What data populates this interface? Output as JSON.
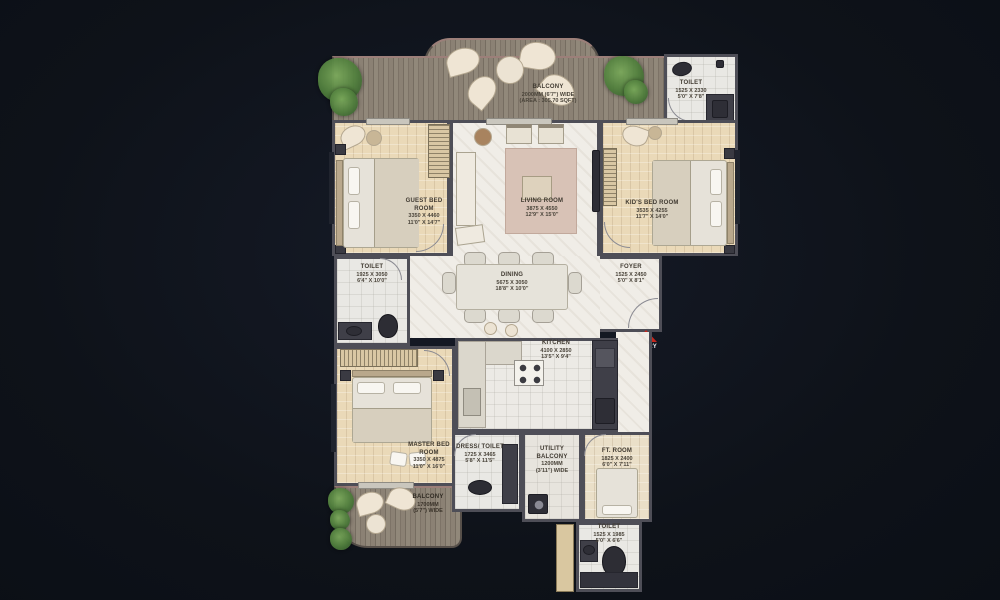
{
  "background_color": "#0e1219",
  "entry": {
    "label": "ENTRY",
    "arrow_color": "#c4271e"
  },
  "rooms": {
    "balcony_top": {
      "name": "BALCONY",
      "line2": "2000MM (6'7\") WIDE",
      "line3": "(AREA : 305.70 SQFT)"
    },
    "toilet_top": {
      "name": "TOILET",
      "dims_mm": "1525 X 2330",
      "dims_ft": "5'0\" X 7'8\""
    },
    "guest_bedroom": {
      "name": "GUEST BED ROOM",
      "dims_mm": "3350 X 4460",
      "dims_ft": "11'0\" X 14'7\""
    },
    "living_room": {
      "name": "LIVING ROOM",
      "dims_mm": "3875 X 4550",
      "dims_ft": "12'9\" X 15'0\""
    },
    "kids_bedroom": {
      "name": "KID'S BED ROOM",
      "dims_mm": "3535 X 4255",
      "dims_ft": "11'7\" X 14'0\""
    },
    "toilet_left": {
      "name": "TOILET",
      "dims_mm": "1925 X 3050",
      "dims_ft": "6'4\" X 10'0\""
    },
    "dining": {
      "name": "DINING",
      "dims_mm": "5675 X 3050",
      "dims_ft": "18'8\" X 10'0\""
    },
    "foyer": {
      "name": "FOYER",
      "dims_mm": "1525 X 2450",
      "dims_ft": "5'0\" X 8'1\""
    },
    "kitchen": {
      "name": "KITCHEN",
      "dims_mm": "4100 X 2850",
      "dims_ft": "13'5\" X 9'4\""
    },
    "master_bedroom": {
      "name": "MASTER BED ROOM",
      "dims_mm": "3350 X 4875",
      "dims_ft": "11'0\" X 16'0\""
    },
    "dress_toilet": {
      "name": "DRESS/ TOILET",
      "dims_mm": "1725 X 3465",
      "dims_ft": "5'8\" X 11'5\""
    },
    "utility_balcony": {
      "name": "UTILITY BALCONY",
      "line2": "1200MM",
      "line3": "(3'11\") WIDE"
    },
    "ft_room": {
      "name": "FT. ROOM",
      "dims_mm": "1825 X 2400",
      "dims_ft": "6'0\" X 7'11\""
    },
    "toilet_bottom": {
      "name": "TOILET",
      "dims_mm": "1525 X 1985",
      "dims_ft": "5'0\" X 6'6\""
    },
    "balcony_bottom": {
      "name": "BALCONY",
      "line2": "1700MM",
      "line3": "(5'7\") WIDE"
    }
  }
}
